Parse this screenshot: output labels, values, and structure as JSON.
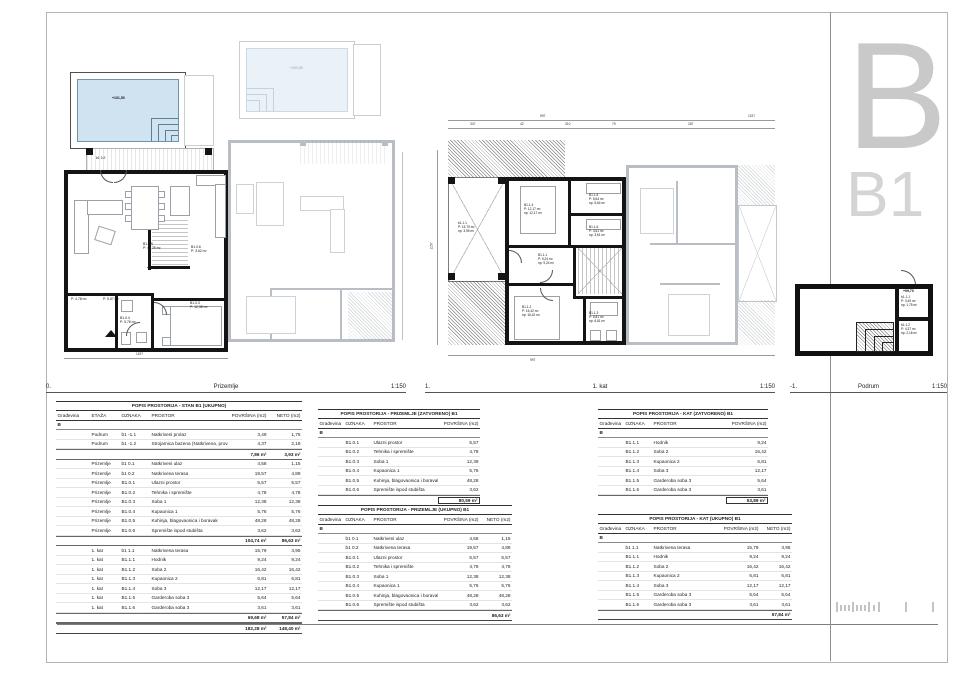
{
  "sheet": {
    "letter": "B",
    "code": "B1"
  },
  "plan_titles": [
    {
      "num": "0.",
      "label": "Prizemlje",
      "scale": "1:150"
    },
    {
      "num": "1.",
      "label": "1. kat",
      "scale": "1:150"
    },
    {
      "num": "-1.",
      "label": "Podrum",
      "scale": "1:150"
    }
  ],
  "plans": {
    "prizemlje": {
      "pool_elev": "+101,50",
      "floor_elev": "+102,20",
      "dim_total": "1197",
      "rooms": [
        {
          "id": "B1.0.5",
          "a": "P: 48,28 m²"
        },
        {
          "id": "B1.0.3",
          "a": "P: 12,38 m²"
        },
        {
          "id": "B1.0.4",
          "a": "P: 5,76 m²"
        },
        {
          "id": "B1.0.1",
          "a": "P: 5,57 m²"
        },
        {
          "id": "B1.0.2",
          "a": "P: 4,78 m²"
        },
        {
          "id": "B1.0.6",
          "a": "P: 3,62 m²"
        },
        {
          "id": "b1 0.2",
          "a": "P: 19,57 m²"
        }
      ]
    },
    "kat": {
      "dims_top_row1": [
        "997",
        "1197"
      ],
      "dims_top_row2": [
        "347",
        "42",
        "310",
        "79",
        "287"
      ],
      "dim_left": "1157",
      "dim_bottom": "997",
      "rooms": [
        {
          "id": "b1.1.1",
          "a": "P: 15,79 m²",
          "n": "np: 3,95 m²"
        },
        {
          "id": "B1.1.4",
          "a": "P: 12,17 m²",
          "n": "np: 12,17 m²"
        },
        {
          "id": "B1.1.5",
          "a": "P: 5,64 m²",
          "n": "np: 5,64 m²"
        },
        {
          "id": "B1.1.6",
          "a": "P: 3,61 m²",
          "n": "np: 3,61 m²"
        },
        {
          "id": "B1.1.1",
          "a": "P: 9,24 m²",
          "n": "np: 9,24 m²"
        },
        {
          "id": "B1.1.2",
          "a": "P: 16,42 m²",
          "n": "np: 16,42 m²"
        },
        {
          "id": "B1.1.3",
          "a": "P: 6,81 m²",
          "n": "np: 6,81 m²"
        }
      ]
    },
    "podrum": {
      "elev": "+99,70",
      "rooms": [
        {
          "id": "b1-1.1",
          "a": "P: 3,49 m²",
          "n": "np: 1,75 m²"
        },
        {
          "id": "b1-1.2",
          "a": "P: 4,37 m²",
          "n": "np: 2,18 m²"
        }
      ]
    }
  },
  "tables": {
    "t1": {
      "title": "POPIS PROSTORIJA - STAN B1  (UKUPNO)",
      "headers": [
        "Građevina",
        "ETAŽA",
        "OZNAKA",
        "PROSTOR",
        "POVRŠINA (m2)",
        "NETO (m2)"
      ],
      "building": "B",
      "groups": [
        {
          "rows": [
            [
              "Podrum",
              "b1 -1.1",
              "Natkriveni prolaz",
              "3,49",
              "1,75"
            ],
            [
              "Podrum",
              "b1 -1.2",
              "Strojarnica bazena (Natkrivena, prov.)",
              "4,37",
              "2,18"
            ]
          ],
          "subtotal": [
            "7,86 m²",
            "3,93 m²"
          ]
        },
        {
          "rows": [
            [
              "Prizemlje",
              "b1 0.1",
              "Natkriveni ulaz",
              "4,58",
              "1,15"
            ],
            [
              "Prizemlje",
              "b1 0.2",
              "Natkrivena terasa",
              "19,57",
              "4,89"
            ],
            [
              "Prizemlje",
              "B1.0.1",
              "Ulazni prostor",
              "5,57",
              "5,57"
            ],
            [
              "Prizemlje",
              "B1.0.2",
              "Tehnika i spremište",
              "4,78",
              "4,78"
            ],
            [
              "Prizemlje",
              "B1.0.3",
              "Soba 1",
              "12,38",
              "12,38"
            ],
            [
              "Prizemlje",
              "B1.0.4",
              "Kupaonica 1",
              "5,76",
              "5,76"
            ],
            [
              "Prizemlje",
              "B1.0.5",
              "Kuhinja, blagovaonica i boravak",
              "48,28",
              "48,28"
            ],
            [
              "Prizemlje",
              "B1.0.6",
              "Spremište ispod stubišta",
              "3,62",
              "3,62"
            ]
          ],
          "subtotal": [
            "104,74 m²",
            "86,63 m²"
          ]
        },
        {
          "rows": [
            [
              "1. kat",
              "b1 1.1",
              "Natkrivena terasa",
              "15,79",
              "3,95"
            ],
            [
              "1. kat",
              "B1.1.1",
              "Hodnik",
              "9,24",
              "9,24"
            ],
            [
              "1. kat",
              "B1.1.2",
              "Soba 2",
              "16,42",
              "16,42"
            ],
            [
              "1. kat",
              "B1.1.3",
              "Kupaonica 2",
              "6,81",
              "6,81"
            ],
            [
              "1. kat",
              "B1.1.4",
              "Soba 3",
              "12,17",
              "12,17"
            ],
            [
              "1. kat",
              "B1.1.5",
              "Garderoba soba 3",
              "5,64",
              "5,64"
            ],
            [
              "1. kat",
              "B1.1.6",
              "Garderoba soba 3",
              "3,61",
              "3,61"
            ]
          ],
          "subtotal": [
            "69,68 m²",
            "57,84 m²"
          ]
        }
      ],
      "total": [
        "182,28 m²",
        "148,40 m²"
      ]
    },
    "t2": {
      "title": "POPIS PROSTORIJA - PRIZEMLJE  (ZATVORENO)  B1",
      "headers": [
        "Građevina",
        "OZNAKA",
        "PROSTOR",
        "POVRŠINA (m2)"
      ],
      "building": "B",
      "groups": [
        {
          "rows": [
            [
              "B1.0.1",
              "Ulazni prostor",
              "5,57"
            ],
            [
              "B1.0.2",
              "Tehnika i spremište",
              "4,78"
            ],
            [
              "B1.0.3",
              "Soba 1",
              "12,38"
            ],
            [
              "B1.0.4",
              "Kupaonica 1",
              "5,76"
            ],
            [
              "B1.0.5",
              "Kuhinja, blagovaonica i boravak",
              "48,28"
            ],
            [
              "B1.0.6",
              "Spremište ispod stubišta",
              "3,62"
            ]
          ]
        }
      ],
      "total": "80,59 m²"
    },
    "t3": {
      "title": "POPIS PROSTORIJA - PRIZEMLJE  (UKUPNO)  B1",
      "headers": [
        "Građevina",
        "OZNAKA",
        "PROSTOR",
        "POVRŠINA (m2)",
        "NETO (m2)"
      ],
      "building": "B",
      "groups": [
        {
          "rows": [
            [
              "b1 0.1",
              "Natkriveni ulaz",
              "4,58",
              "1,15"
            ],
            [
              "b1 0.2",
              "Natkrivena terasa",
              "19,57",
              "4,89"
            ],
            [
              "B1.0.1",
              "Ulazni prostor",
              "5,57",
              "5,57"
            ],
            [
              "B1.0.2",
              "Tehnika i spremište",
              "4,78",
              "4,78"
            ],
            [
              "B1.0.3",
              "Soba 1",
              "12,38",
              "12,38"
            ],
            [
              "B1.0.4",
              "Kupaonica 1",
              "5,76",
              "5,76"
            ],
            [
              "B1.0.5",
              "Kuhinja, blagovaonica i boravak",
              "48,28",
              "48,28"
            ],
            [
              "B1.0.6",
              "Spremište ispod stubišta",
              "3,62",
              "3,62"
            ]
          ]
        }
      ],
      "total": [
        "86,63 m²"
      ]
    },
    "t4": {
      "title": "POPIS PROSTORIJA - KAT  (ZATVORENO)  B1",
      "headers": [
        "Građevina",
        "OZNAKA",
        "PROSTOR",
        "POVRŠINA (m2)"
      ],
      "building": "B",
      "groups": [
        {
          "rows": [
            [
              "B1.1.1",
              "Hodnik",
              "9,24"
            ],
            [
              "B1.1.2",
              "Soba 2",
              "16,42"
            ],
            [
              "B1.1.3",
              "Kupaonica 2",
              "6,81"
            ],
            [
              "B1.1.4",
              "Soba 3",
              "12,17"
            ],
            [
              "B1.1.5",
              "Garderoba soba 3",
              "5,64"
            ],
            [
              "B1.1.6",
              "Garderoba soba 3",
              "3,61"
            ]
          ]
        }
      ],
      "total": "53,89 m²"
    },
    "t5": {
      "title": "POPIS PROSTORIJA - KAT  (UKUPNO) B1",
      "headers": [
        "Građevina",
        "OZNAKA",
        "PROSTOR",
        "POVRŠINA (m2)",
        "NETO (m2)"
      ],
      "building": "B",
      "groups": [
        {
          "rows": [
            [
              "b1 1.1",
              "Natkrivena terasa",
              "15,79",
              "3,95"
            ],
            [
              "B1.1.1",
              "Hodnik",
              "9,24",
              "9,24"
            ],
            [
              "B1.1.2",
              "Soba 2",
              "16,42",
              "16,42"
            ],
            [
              "B1.1.3",
              "Kupaonica 2",
              "6,81",
              "6,81"
            ],
            [
              "B1.1.4",
              "Soba 3",
              "12,17",
              "12,17"
            ],
            [
              "B1.1.5",
              "Garderoba soba 3",
              "5,64",
              "5,64"
            ],
            [
              "B1.1.6",
              "Garderoba soba 3",
              "3,61",
              "3,61"
            ]
          ]
        }
      ],
      "total": [
        "57,84 m²"
      ]
    }
  }
}
